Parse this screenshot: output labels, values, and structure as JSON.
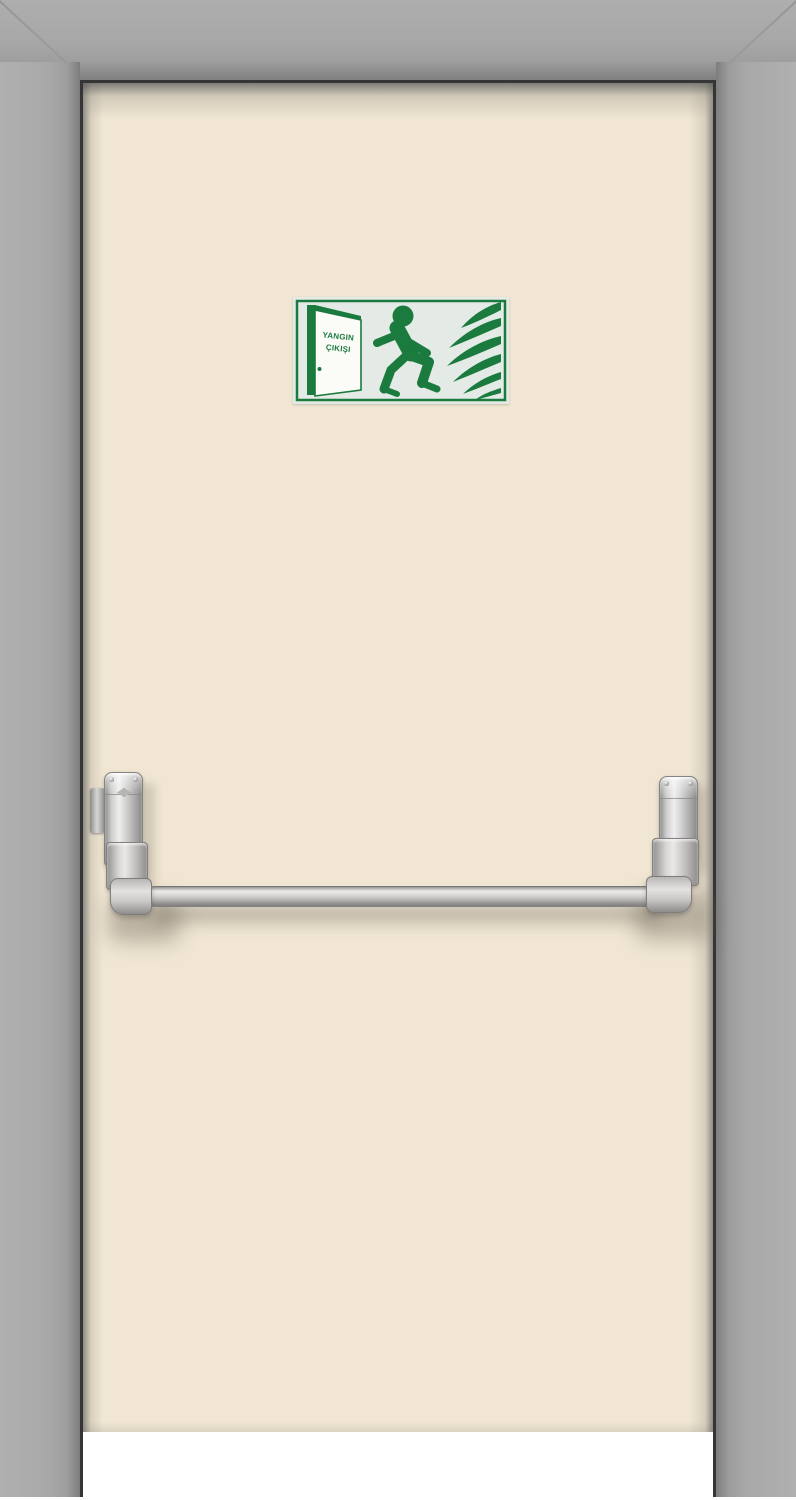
{
  "scene": {
    "description": "Cream fire exit door in a gray steel frame with a green fire-exit sign and a stainless panic push bar",
    "sign": {
      "label_line1": "YANGIN",
      "label_line2": "ÇIKIŞI",
      "pictograms": [
        "open-door-icon",
        "running-man-icon",
        "flames-icon"
      ]
    },
    "icons": {
      "open_door": "open exit door pictogram",
      "running_man": "running person pictogram",
      "flames": "fire flames pictogram",
      "brand": "diamond hardware logo"
    },
    "colors": {
      "frame_gray": "#a9a9a9",
      "frame_reveal": "#8c8c8c",
      "gap_dark": "#353535",
      "door_cream": "#f0e6d3",
      "sign_green": "#1b7b3f",
      "sign_bg": "#e4eae5",
      "hardware_silver": "#c7c6c7",
      "background_white": "#ffffff"
    }
  }
}
